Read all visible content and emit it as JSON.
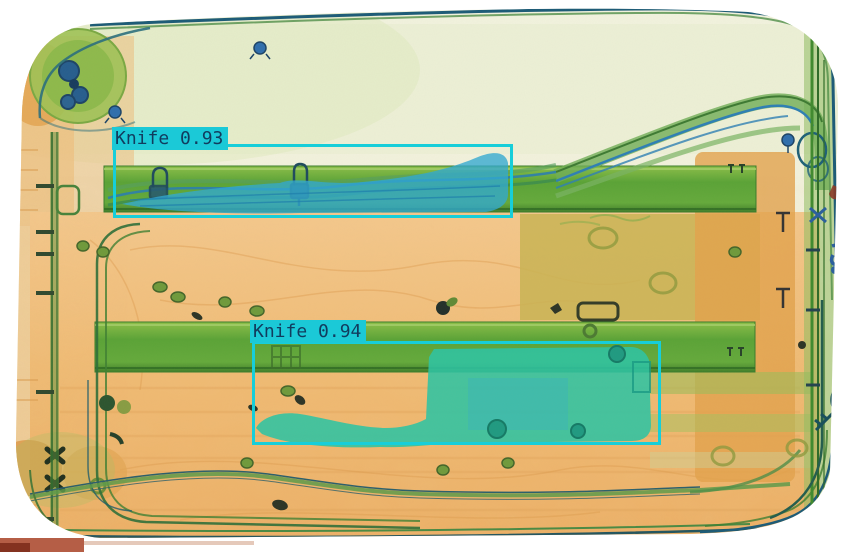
{
  "scene": {
    "type": "xray-baggage-scan"
  },
  "style": {
    "box_color": "#17ced9",
    "label_bg": "#1bc9d7",
    "label_text_color": "#113c5e"
  },
  "detections": [
    {
      "label": "Knife",
      "confidence": "0.93",
      "display_text": "Knife 0.93",
      "box": {
        "x": 113,
        "y": 144,
        "width": 400,
        "height": 74
      },
      "label_box": {
        "x": 112,
        "y": 127
      }
    },
    {
      "label": "Knife",
      "confidence": "0.94",
      "display_text": "Knife 0.94",
      "box": {
        "x": 252,
        "y": 341,
        "width": 409,
        "height": 104
      },
      "label_box": {
        "x": 250,
        "y": 320
      }
    }
  ]
}
